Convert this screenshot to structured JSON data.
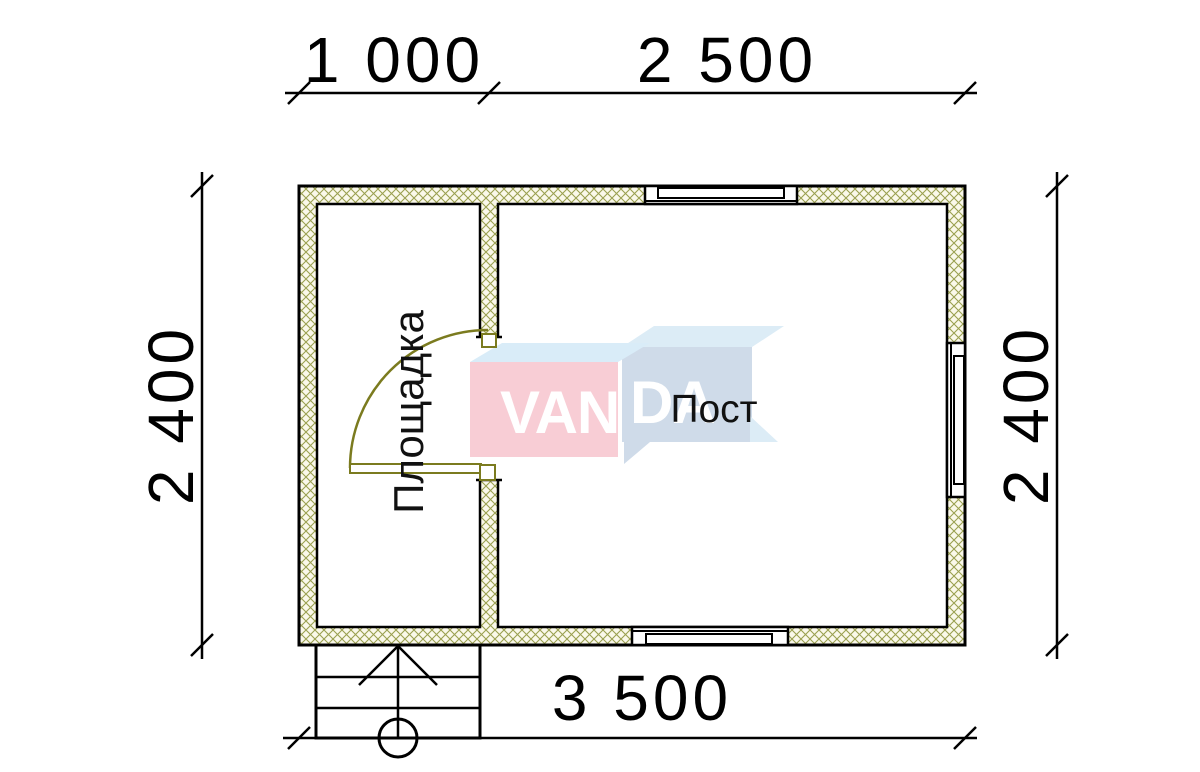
{
  "page": {
    "background": "#ffffff"
  },
  "dimensions": {
    "top_left": "1 000",
    "top_right": "2 500",
    "bottom": "3 500",
    "left": "2 400",
    "right": "2 400"
  },
  "rooms": {
    "vestibule_label": "Площадка",
    "main_label": "Пост"
  },
  "watermark": {
    "brand_left": "VAN",
    "brand_right": "DA",
    "pink": "#f8cdd5",
    "blue_front": "#cfdbe9",
    "blue_top_left": "#d9ecf8",
    "blue_top_right": "#dcecf6",
    "text_color": "#ffffff"
  },
  "drawing": {
    "line_color": "#000000",
    "wall_fill": "#faf8ea",
    "wall_hatch_color": "#9aa050",
    "door_color": "#7b7b1f",
    "floor_fill": "#ffffff"
  }
}
